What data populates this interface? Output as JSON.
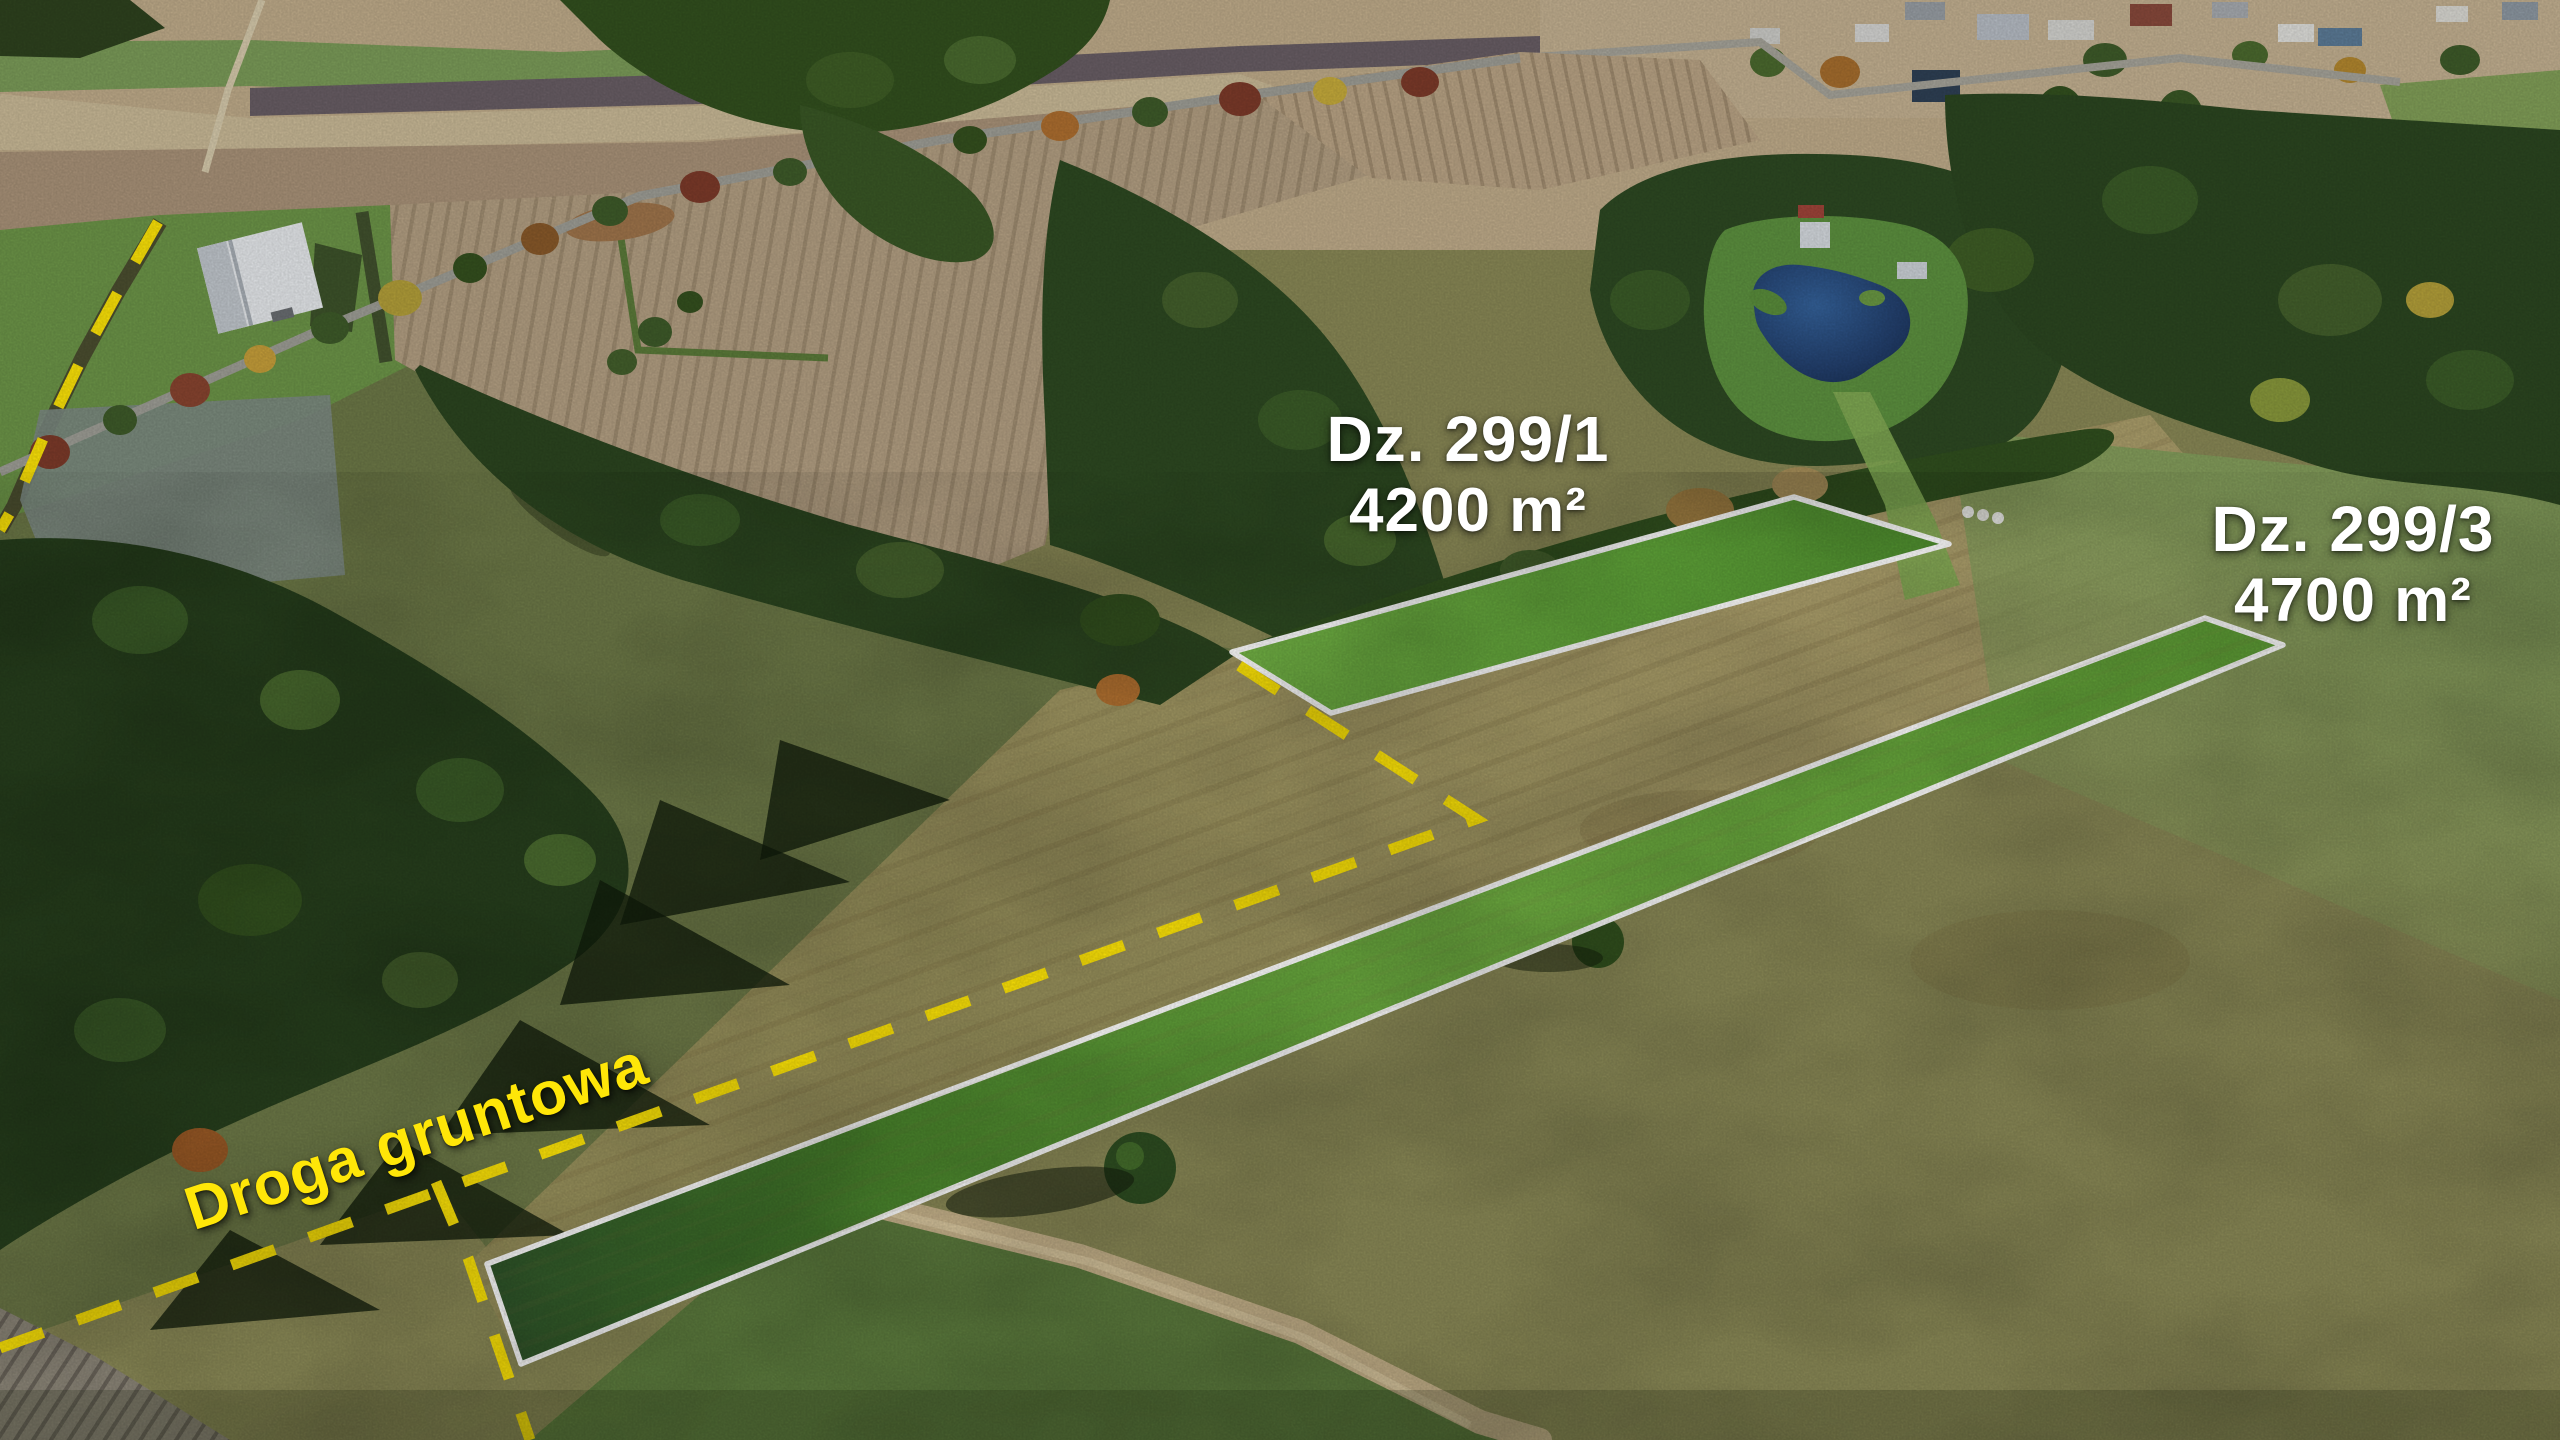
{
  "labels": {
    "parcel1": {
      "line1": "Dz. 299/1",
      "line2": "4200 m²"
    },
    "parcel2": {
      "line1": "Dz. 299/3",
      "line2": "4700 m²"
    },
    "road": "Droga gruntowa"
  },
  "colors": {
    "parcel_outline": "#ffffff",
    "road_dash_yellow": "#ffe608",
    "parcel_label_text": "#ffffff",
    "road_label_text": "#ffe608"
  }
}
